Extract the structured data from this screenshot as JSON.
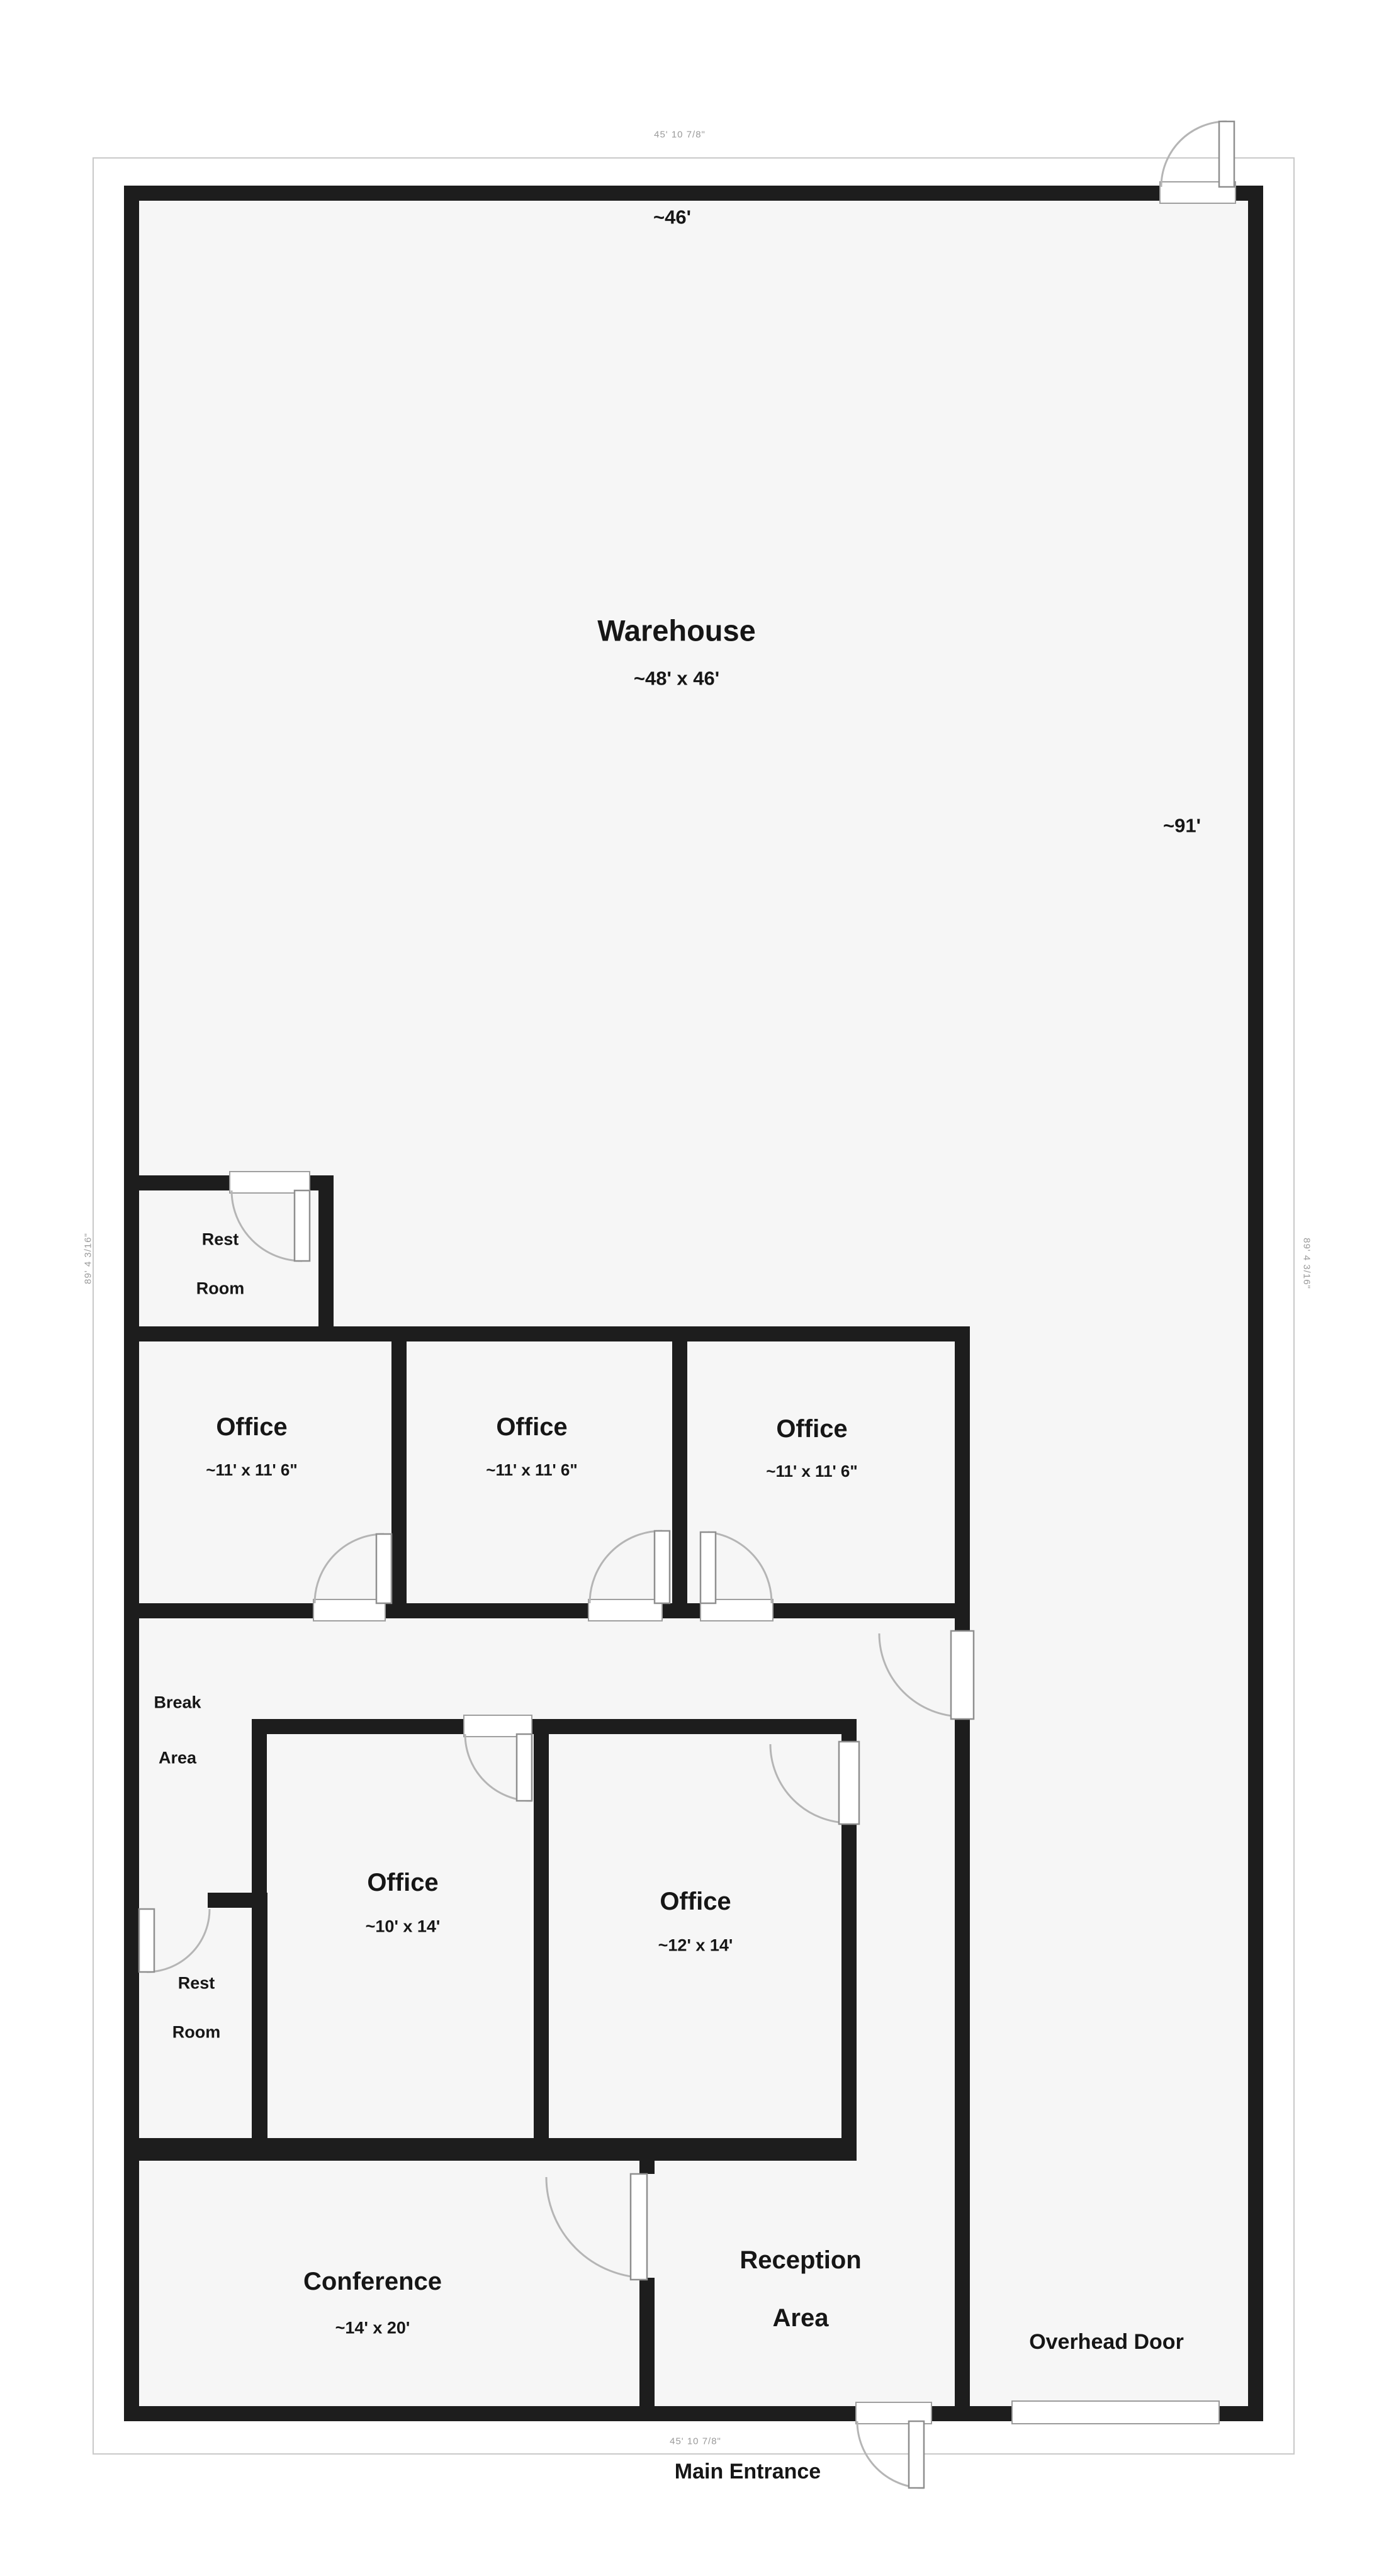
{
  "rooms": {
    "warehouse": {
      "label": "Warehouse",
      "dims": "~48' x 46'"
    },
    "office1": {
      "label": "Office",
      "dims": "~11' x 11' 6\""
    },
    "office2": {
      "label": "Office",
      "dims": "~11' x 11' 6\""
    },
    "office3": {
      "label": "Office",
      "dims": "~11' x 11' 6\""
    },
    "office_10x14": {
      "label": "Office",
      "dims": "~10' x 14'"
    },
    "office_12x14": {
      "label": "Office",
      "dims": "~12' x 14'"
    },
    "conference": {
      "label": "Conference",
      "dims": "~14' x 20'"
    },
    "reception": {
      "line1": "Reception",
      "line2": "Area"
    },
    "restroom_upper": {
      "line1": "Rest",
      "line2": "Room"
    },
    "restroom_lower": {
      "line1": "Rest",
      "line2": "Room"
    },
    "break_area": {
      "line1": "Break",
      "line2": "Area"
    }
  },
  "annotations": {
    "overhead_door": "Overhead Door",
    "main_entrance": "Main Entrance",
    "interior_width": "~46'",
    "interior_height": "~91'",
    "exterior_width_top": "45' 10 7/8\"",
    "exterior_width_bottom": "45' 10 7/8\"",
    "exterior_height_left": "89' 4 3/16\"",
    "exterior_height_right": "89' 4 3/16\""
  },
  "colors": {
    "wall": "#1d1d1d",
    "floor": "#f6f6f6",
    "dim_text": "#9a9a9a",
    "door_arc": "#b5b5b5"
  }
}
